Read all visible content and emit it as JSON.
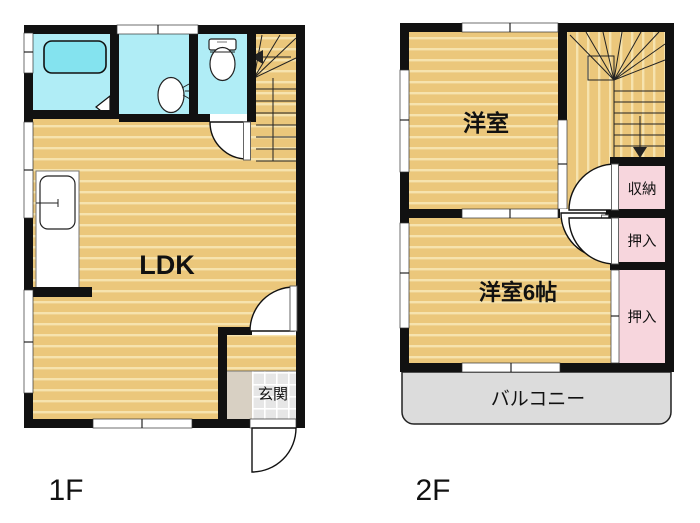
{
  "plan": {
    "floor1": {
      "label": "1F",
      "rooms": {
        "ldk": "LDK",
        "genkan": "玄関"
      }
    },
    "floor2": {
      "label": "2F",
      "rooms": {
        "yoshitsu": "洋室",
        "yoshitsu6": "洋室6帖",
        "shuno": "収納",
        "oshiire_upper": "押入",
        "oshiire_lower": "押入",
        "balcony": "バルコニー"
      }
    }
  },
  "colors": {
    "floor_wood": "#ebc77b",
    "floor_stripe": "#f6e3ae",
    "water_room": "#b0edf6",
    "bathtub": "#84e3ef",
    "closet_pink": "#f7d6dd",
    "balcony_gray": "#dcdcdc",
    "tile_gray": "#e6e6e6",
    "step_gray": "#d8d0c3",
    "wall": "#111111"
  }
}
